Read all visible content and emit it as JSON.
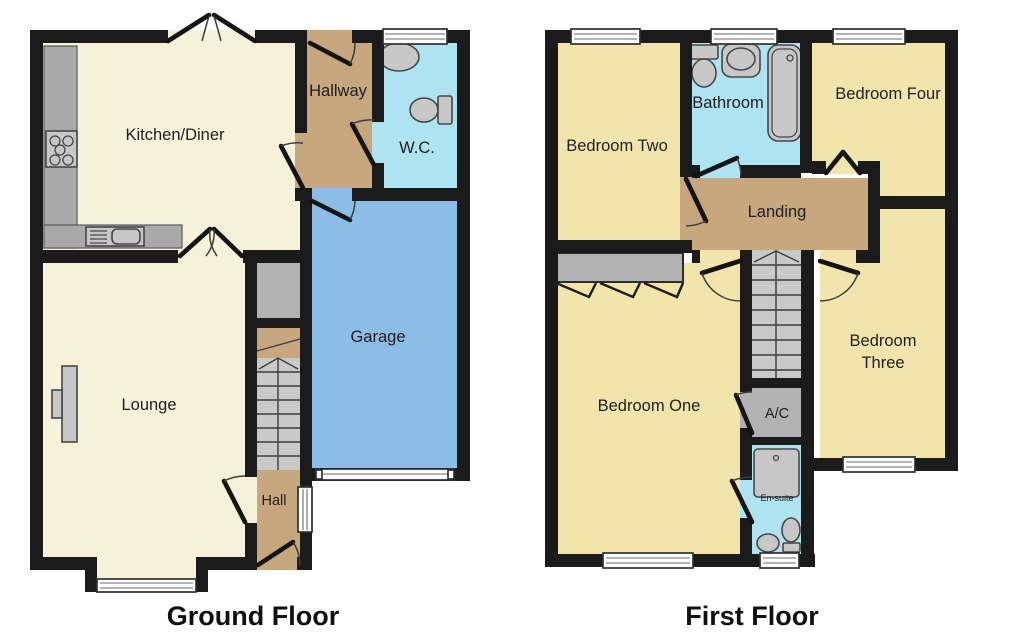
{
  "document": {
    "type": "floor-plan",
    "floor_count": 2
  },
  "colors": {
    "wall": "#1b1b1b",
    "room-cream": "#f6f1d9",
    "room-tan": "#c7a77d",
    "room-cyan": "#aee3f1",
    "room-blue": "#8cbde6",
    "room-yellow": "#f2e5ab",
    "stair-grey": "#c9c9c9",
    "unit-grey": "#b2b2b2",
    "counter-grey": "#a9a9a9",
    "fixture-grey": "#c7c7c7",
    "fixture-outline": "#474747",
    "label": "#1e1e1e"
  },
  "floors": [
    {
      "title": "Ground Floor",
      "rooms": [
        {
          "label": "Kitchen/Diner"
        },
        {
          "label": "Hallway"
        },
        {
          "label": "W.C."
        },
        {
          "label": "Garage"
        },
        {
          "label": "Lounge"
        },
        {
          "label": "Hall"
        }
      ]
    },
    {
      "title": "First Floor",
      "rooms": [
        {
          "label": "Bedroom Two"
        },
        {
          "label": "Bathroom"
        },
        {
          "label": "Bedroom Four"
        },
        {
          "label": "Landing"
        },
        {
          "label": "Bedroom One"
        },
        {
          "label": "A/C"
        },
        {
          "label": "Bedroom Three",
          "lines": [
            "Bedroom",
            "Three"
          ]
        },
        {
          "label": "En-suite"
        }
      ]
    }
  ]
}
